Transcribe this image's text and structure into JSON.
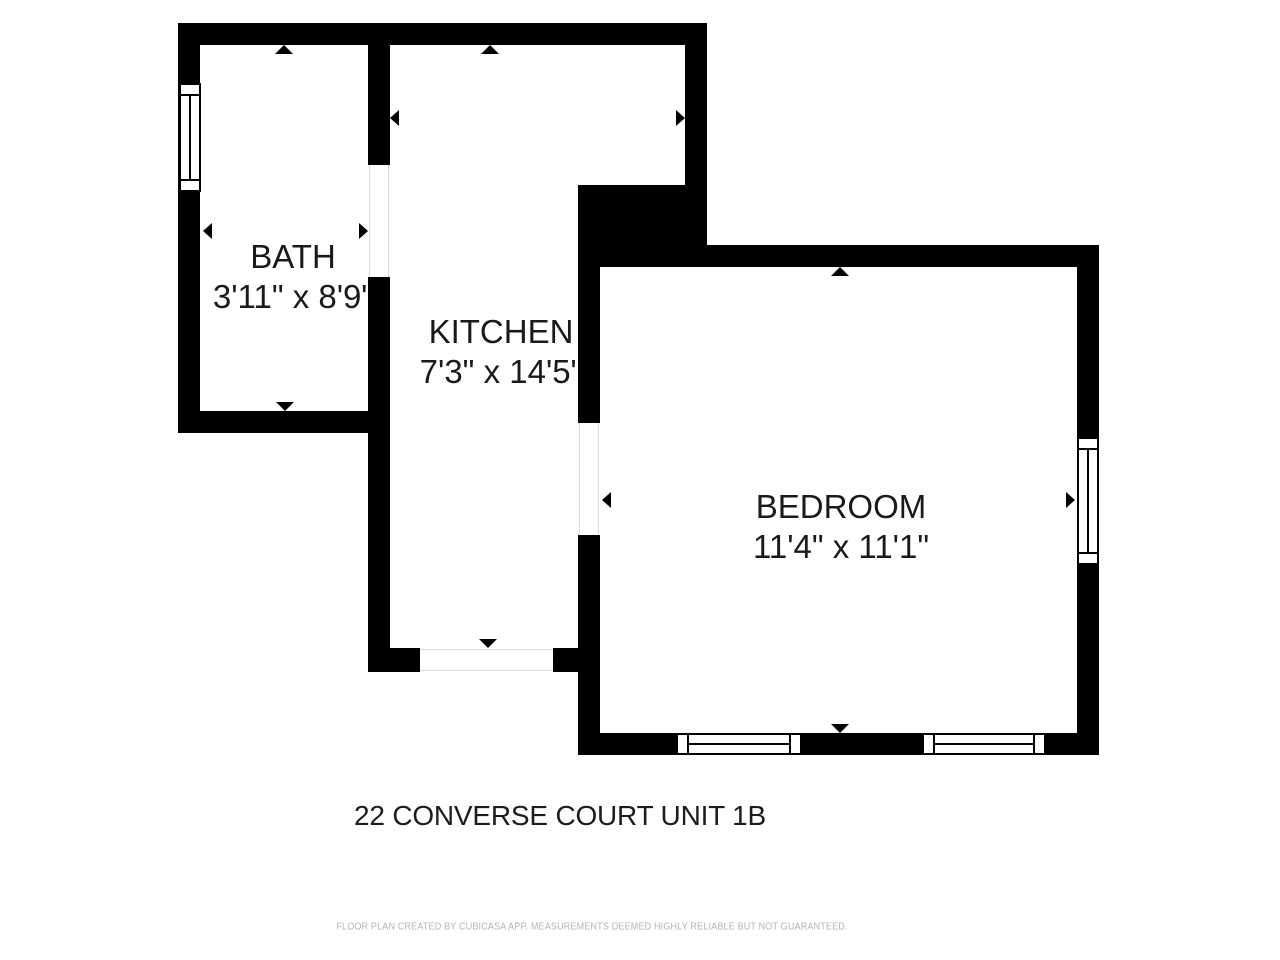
{
  "title": "22 CONVERSE COURT UNIT 1B",
  "footer": "FLOOR PLAN CREATED BY CUBICASA APP. MEASUREMENTS DEEMED HIGHLY RELIABLE BUT NOT GUARANTEED.",
  "colors": {
    "wall": "#000000",
    "background": "#ffffff",
    "label_text": "#1a1a1a",
    "footer_text": "#b4b4b4",
    "opening_line": "#d9d9d9"
  },
  "rooms": [
    {
      "name": "BATH",
      "dims": "3'11\" x 8'9\""
    },
    {
      "name": "KITCHEN",
      "dims": "7'3\" x 14'5\""
    },
    {
      "name": "BEDROOM",
      "dims": "11'4\" x 11'1\""
    }
  ],
  "plan": {
    "walls": [
      [
        178,
        23,
        529,
        22
      ],
      [
        178,
        23,
        22,
        410
      ],
      [
        178,
        411,
        212,
        22
      ],
      [
        368,
        45,
        22,
        120
      ],
      [
        368,
        277,
        22,
        395
      ],
      [
        368,
        648,
        52,
        24
      ],
      [
        553,
        648,
        47,
        24
      ],
      [
        685,
        23,
        22,
        162
      ],
      [
        578,
        185,
        129,
        82
      ],
      [
        578,
        245,
        521,
        22
      ],
      [
        1077,
        245,
        22,
        510
      ],
      [
        578,
        733,
        521,
        22
      ],
      [
        578,
        267,
        22,
        156
      ],
      [
        578,
        535,
        22,
        220
      ]
    ],
    "windows": [
      {
        "x": 179,
        "y": 83,
        "w": 22,
        "h": 109,
        "o": "v"
      },
      {
        "x": 1077,
        "y": 437,
        "w": 22,
        "h": 128,
        "o": "v"
      },
      {
        "x": 676,
        "y": 733,
        "w": 126,
        "h": 22,
        "o": "h"
      },
      {
        "x": 922,
        "y": 733,
        "w": 124,
        "h": 22,
        "o": "h"
      }
    ],
    "openings": [
      {
        "x": 369,
        "y": 165,
        "w": 20,
        "h": 112,
        "o": "v"
      },
      {
        "x": 420,
        "y": 649,
        "w": 133,
        "h": 22,
        "o": "h"
      },
      {
        "x": 579,
        "y": 423,
        "w": 20,
        "h": 112,
        "o": "v"
      }
    ],
    "arrows": [
      {
        "x": 284,
        "y": 45,
        "d": "up"
      },
      {
        "x": 285,
        "y": 411,
        "d": "down"
      },
      {
        "x": 203,
        "y": 231,
        "d": "left"
      },
      {
        "x": 368,
        "y": 231,
        "d": "right"
      },
      {
        "x": 490,
        "y": 45,
        "d": "up"
      },
      {
        "x": 390,
        "y": 118,
        "d": "left"
      },
      {
        "x": 685,
        "y": 118,
        "d": "right"
      },
      {
        "x": 488,
        "y": 648,
        "d": "down"
      },
      {
        "x": 840,
        "y": 267,
        "d": "up"
      },
      {
        "x": 840,
        "y": 733,
        "d": "down"
      },
      {
        "x": 602,
        "y": 500,
        "d": "left"
      },
      {
        "x": 1075,
        "y": 500,
        "d": "right"
      }
    ]
  }
}
